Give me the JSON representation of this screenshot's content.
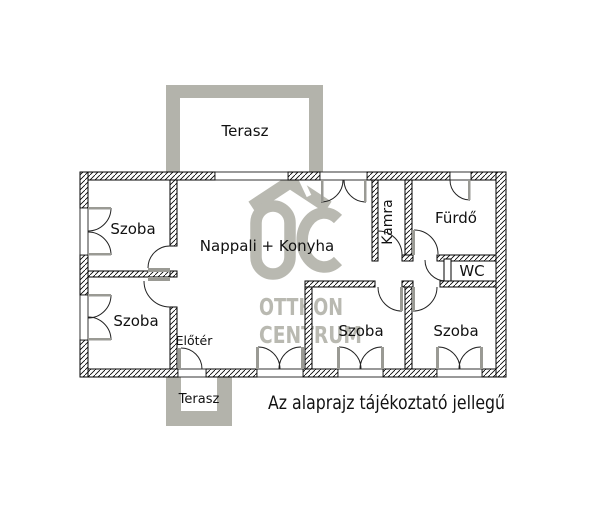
{
  "watermark": {
    "brand_line1": "OTTHON",
    "brand_line2": "CENTRUM",
    "logo_letters": "OC",
    "color": "#b9b9b1"
  },
  "terraces": {
    "top": "Terasz",
    "bottom": "Terasz"
  },
  "rooms": {
    "szoba_top_left": "Szoba",
    "szoba_bottom_left": "Szoba",
    "szoba_bottom_middle": "Szoba",
    "szoba_bottom_right": "Szoba",
    "living_kitchen": "Nappali + Konyha",
    "hall": "Előtér",
    "pantry": "Kamra",
    "bathroom": "Fürdő",
    "wc": "WC"
  },
  "note": "Az alaprajz tájékoztató jellegű",
  "colors": {
    "wall_line": "#000000",
    "terrace_gray": "#b3b3ab",
    "watermark_gray": "#b9b9b1",
    "fixture_gray": "#9a9a94",
    "background": "#ffffff",
    "text": "#111111"
  }
}
